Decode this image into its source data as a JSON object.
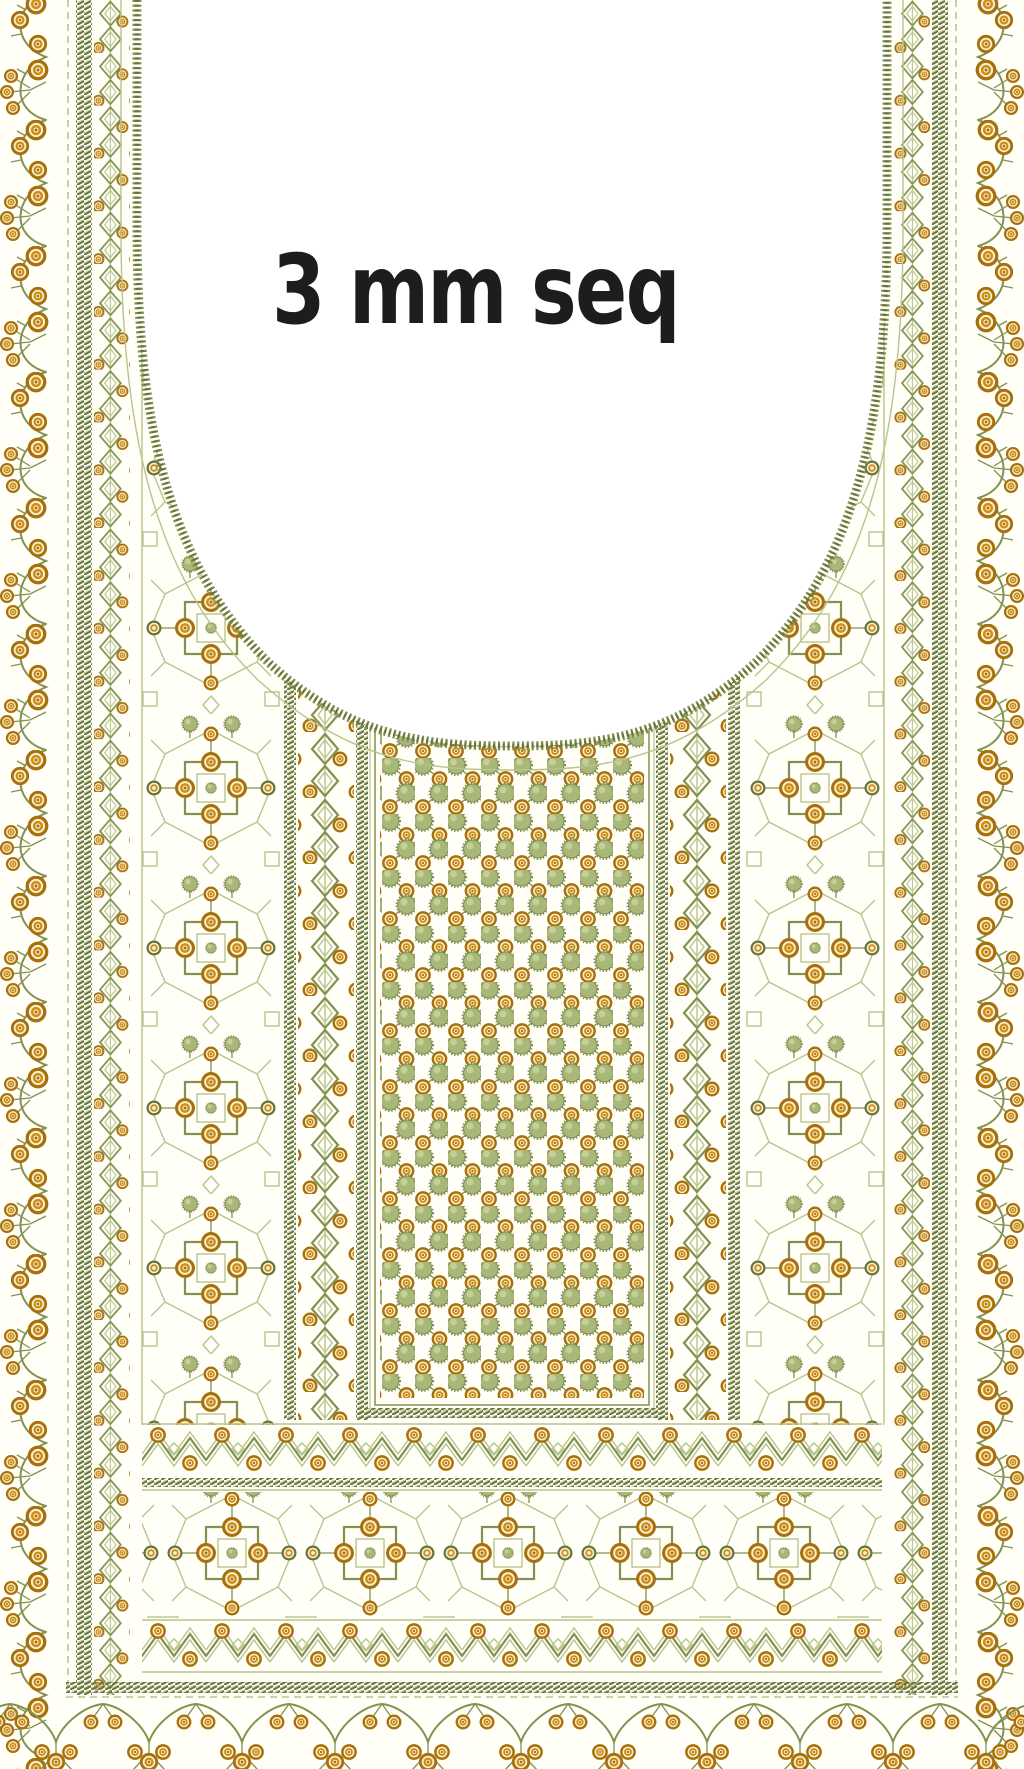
{
  "annotation": {
    "label": "3 mm seq"
  },
  "palette": {
    "pageBg": "#fffef7",
    "neckBg": "#ffffff",
    "olive": "#82914f",
    "oliveDark": "#66743c",
    "oliveLight": "#b9c48e",
    "pomFill": "#a9b878",
    "pomEdge": "#7c8b4e",
    "pomHi": "#ccd6a0",
    "gold": "#cf8d10",
    "goldDark": "#a8700a",
    "goldLight": "#f0e0b4",
    "cream": "#f6efd8",
    "textInk": "#1d1d1f"
  },
  "design": {
    "type": "embroidery-neckline-design-preview",
    "regions": [
      "left-floral-vine-border",
      "left-chain-and-leaf-band",
      "left-star-lattice-panel",
      "inner-leaf-chain-bands",
      "center-pom-sequin-panel",
      "right-star-lattice-panel",
      "right-chain-and-leaf-band",
      "right-floral-vine-border",
      "chevron-sequin-bands",
      "bottom-star-lattice-field",
      "bottom-floral-garland",
      "u-neck-opening-with-rope-stitch-edge"
    ]
  }
}
